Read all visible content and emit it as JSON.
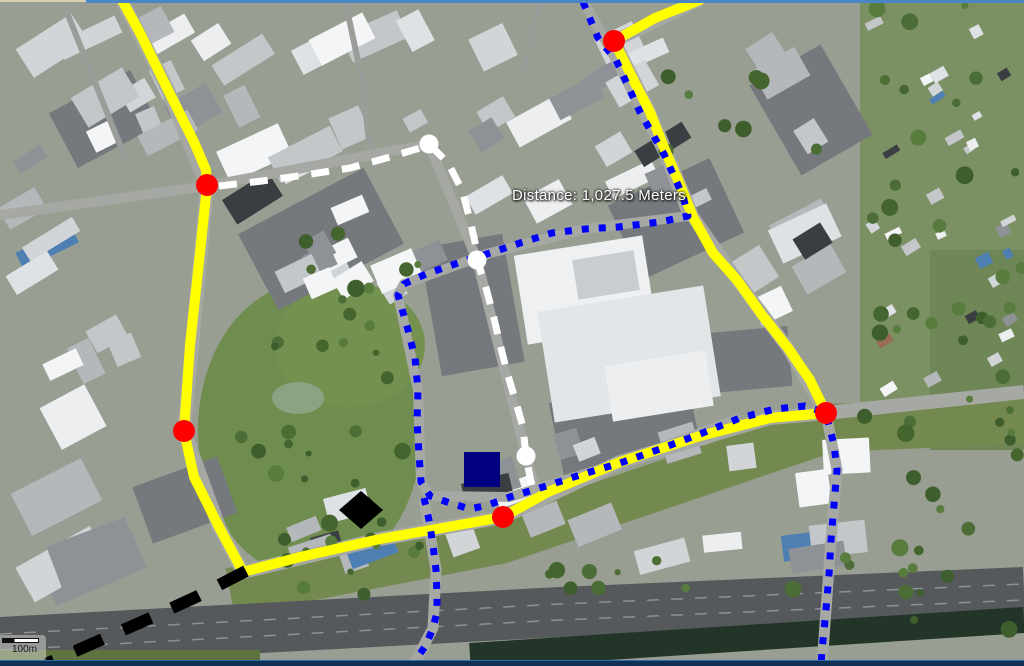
{
  "window": {
    "top_edge_left_color": "#d8d0ae",
    "top_edge_color": "#4a86c4",
    "bottom_bar_color": "#0f3154",
    "bottom_bar_highlight": "#2f6ba6"
  },
  "map": {
    "type": "satellite-imagery",
    "distance_label": "Distance: 1,027.5 Meters",
    "scale_bar": {
      "label": "100m"
    },
    "overlay": {
      "colors": {
        "route_yellow": "#ffff00",
        "route_blue": "#0000ff",
        "route_white": "#ffffff",
        "route_black": "#000000",
        "marker_red": "#ff0000",
        "marker_white": "#ffffff",
        "marker_navy": "#000080",
        "marker_black": "#000000"
      },
      "routes": [
        {
          "id": "route-yellow-solid",
          "style": "solid",
          "color": "#ffff00",
          "width": 10,
          "dash": "",
          "cap": "round",
          "points": [
            [
              122,
              0
            ],
            [
              140,
              33
            ],
            [
              168,
              90
            ],
            [
              194,
              142
            ],
            [
              206,
              170
            ],
            [
              207,
              186
            ],
            [
              199,
              262
            ],
            [
              190,
              345
            ],
            [
              184,
              431
            ],
            [
              194,
              477
            ],
            [
              219,
              527
            ],
            [
              243,
              572
            ],
            [
              300,
              557
            ],
            [
              380,
              539
            ],
            [
              470,
              523
            ],
            [
              503,
              517
            ],
            [
              548,
              492
            ],
            [
              620,
              462
            ],
            [
              700,
              436
            ],
            [
              770,
              418
            ],
            [
              826,
              413
            ],
            [
              810,
              380
            ],
            [
              788,
              348
            ],
            [
              762,
              315
            ],
            [
              737,
              280
            ],
            [
              713,
              253
            ],
            [
              693,
              217
            ],
            [
              678,
              180
            ],
            [
              665,
              150
            ],
            [
              650,
              112
            ],
            [
              636,
              85
            ],
            [
              614,
              41
            ],
            [
              655,
              18
            ],
            [
              700,
              0
            ]
          ]
        },
        {
          "id": "route-blue-dotted-main",
          "style": "dotted",
          "color": "#0000ff",
          "width": 7,
          "dash": "7 10",
          "cap": "butt",
          "points": [
            [
              583,
              2
            ],
            [
              598,
              38
            ],
            [
              616,
              60
            ],
            [
              640,
              112
            ],
            [
              664,
              154
            ],
            [
              683,
              196
            ],
            [
              688,
              216
            ],
            [
              660,
              222
            ],
            [
              618,
              227
            ],
            [
              585,
              229
            ],
            [
              552,
              233
            ],
            [
              520,
              243
            ],
            [
              490,
              253
            ],
            [
              458,
              263
            ],
            [
              426,
              274
            ],
            [
              404,
              284
            ],
            [
              398,
              295
            ],
            [
              408,
              330
            ],
            [
              415,
              358
            ],
            [
              418,
              390
            ],
            [
              417,
              422
            ],
            [
              419,
              454
            ],
            [
              421,
              482
            ],
            [
              430,
              496
            ],
            [
              450,
              503
            ],
            [
              470,
              509
            ],
            [
              488,
              505
            ],
            [
              510,
              497
            ],
            [
              543,
              487
            ],
            [
              580,
              475
            ],
            [
              620,
              463
            ],
            [
              660,
              449
            ],
            [
              700,
              434
            ],
            [
              740,
              418
            ],
            [
              775,
              409
            ],
            [
              805,
              406
            ],
            [
              826,
              413
            ],
            [
              834,
              445
            ],
            [
              837,
              470
            ],
            [
              834,
              505
            ],
            [
              831,
              540
            ],
            [
              829,
              575
            ],
            [
              826,
              610
            ],
            [
              822,
              650
            ],
            [
              821,
              666
            ]
          ]
        },
        {
          "id": "route-blue-dotted-south",
          "style": "dotted",
          "color": "#0000ff",
          "width": 7,
          "dash": "7 10",
          "cap": "butt",
          "points": [
            [
              424,
              498
            ],
            [
              429,
              520
            ],
            [
              433,
              545
            ],
            [
              436,
              570
            ],
            [
              437,
              595
            ],
            [
              437,
              612
            ],
            [
              433,
              628
            ],
            [
              426,
              645
            ],
            [
              417,
              658
            ],
            [
              413,
              666
            ]
          ]
        },
        {
          "id": "route-white-dashed",
          "style": "dashed",
          "color": "#ffffff",
          "width": 7,
          "dash": "18 13",
          "cap": "butt",
          "points": [
            [
              219,
              186
            ],
            [
              262,
              181
            ],
            [
              305,
              175
            ],
            [
              350,
              168
            ],
            [
              390,
              157
            ],
            [
              420,
              148
            ],
            [
              429,
              144
            ],
            [
              448,
              163
            ],
            [
              462,
              190
            ],
            [
              470,
              220
            ],
            [
              475,
              242
            ],
            [
              477,
              260
            ],
            [
              486,
              288
            ],
            [
              493,
              314
            ],
            [
              500,
              344
            ],
            [
              507,
              372
            ],
            [
              515,
              399
            ],
            [
              523,
              427
            ],
            [
              526,
              456
            ],
            [
              530,
              477
            ],
            [
              534,
              494
            ]
          ]
        },
        {
          "id": "route-black-dashed",
          "style": "dashed",
          "color": "#000000",
          "width": 12,
          "dash": "30 23",
          "cap": "butt",
          "points": [
            [
              246,
              571
            ],
            [
              196,
              597
            ],
            [
              146,
              620
            ],
            [
              96,
              642
            ],
            [
              46,
              664
            ]
          ]
        }
      ],
      "markers": [
        {
          "id": "red-waypoint-top",
          "shape": "circle",
          "color": "#ff0000",
          "x": 614,
          "y": 41,
          "r": 11
        },
        {
          "id": "red-waypoint-left-upper",
          "shape": "circle",
          "color": "#ff0000",
          "x": 207,
          "y": 185,
          "r": 11
        },
        {
          "id": "red-waypoint-left-lower",
          "shape": "circle",
          "color": "#ff0000",
          "x": 184,
          "y": 431,
          "r": 11
        },
        {
          "id": "red-waypoint-bottom",
          "shape": "circle",
          "color": "#ff0000",
          "x": 503,
          "y": 517,
          "r": 11
        },
        {
          "id": "red-waypoint-right",
          "shape": "circle",
          "color": "#ff0000",
          "x": 826,
          "y": 413,
          "r": 11
        },
        {
          "id": "white-waypoint-upper",
          "shape": "circle",
          "color": "#ffffff",
          "x": 429,
          "y": 144,
          "r": 9.5
        },
        {
          "id": "white-waypoint-middle",
          "shape": "circle",
          "color": "#ffffff",
          "x": 477,
          "y": 260,
          "r": 9.5
        },
        {
          "id": "white-waypoint-lower",
          "shape": "circle",
          "color": "#ffffff",
          "x": 526,
          "y": 456,
          "r": 9.5
        },
        {
          "id": "navy-square-marker",
          "shape": "square",
          "color": "#000080",
          "x": 464,
          "y": 452,
          "w": 36,
          "h": 35
        },
        {
          "id": "black-diamond-marker",
          "shape": "diamond",
          "color": "#000000",
          "x": 361,
          "y": 510,
          "rx": 22,
          "ry": 19
        }
      ]
    }
  }
}
